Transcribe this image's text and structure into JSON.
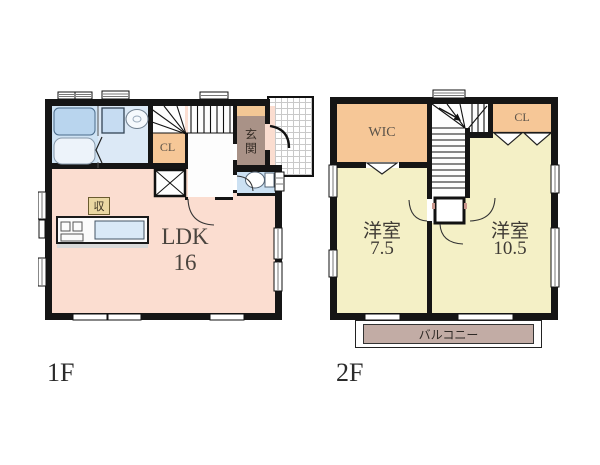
{
  "floor1": {
    "label": "1F",
    "rooms": {
      "ldk": {
        "name": "LDK",
        "size": "16"
      },
      "closet": "CL",
      "storage": "収",
      "entrance": "玄関"
    }
  },
  "floor2": {
    "label": "2F",
    "rooms": {
      "wic": "WIC",
      "closet": "CL",
      "bedroom_left": {
        "name": "洋室",
        "size": "7.5"
      },
      "bedroom_right": {
        "name": "洋室",
        "size": "10.5"
      },
      "balcony": "バルコニー"
    }
  },
  "colors": {
    "walls": "#151515",
    "ldk_fill": "#FBDDD0",
    "bedroom_fill": "#F4F0C6",
    "closet_fill": "#F6C797",
    "bath_fill": "#CFE3F4",
    "balcony_fill": "#C2ACA5",
    "entrance_fill": "#A99287",
    "storage_label_bg": "#EAD7A2"
  }
}
